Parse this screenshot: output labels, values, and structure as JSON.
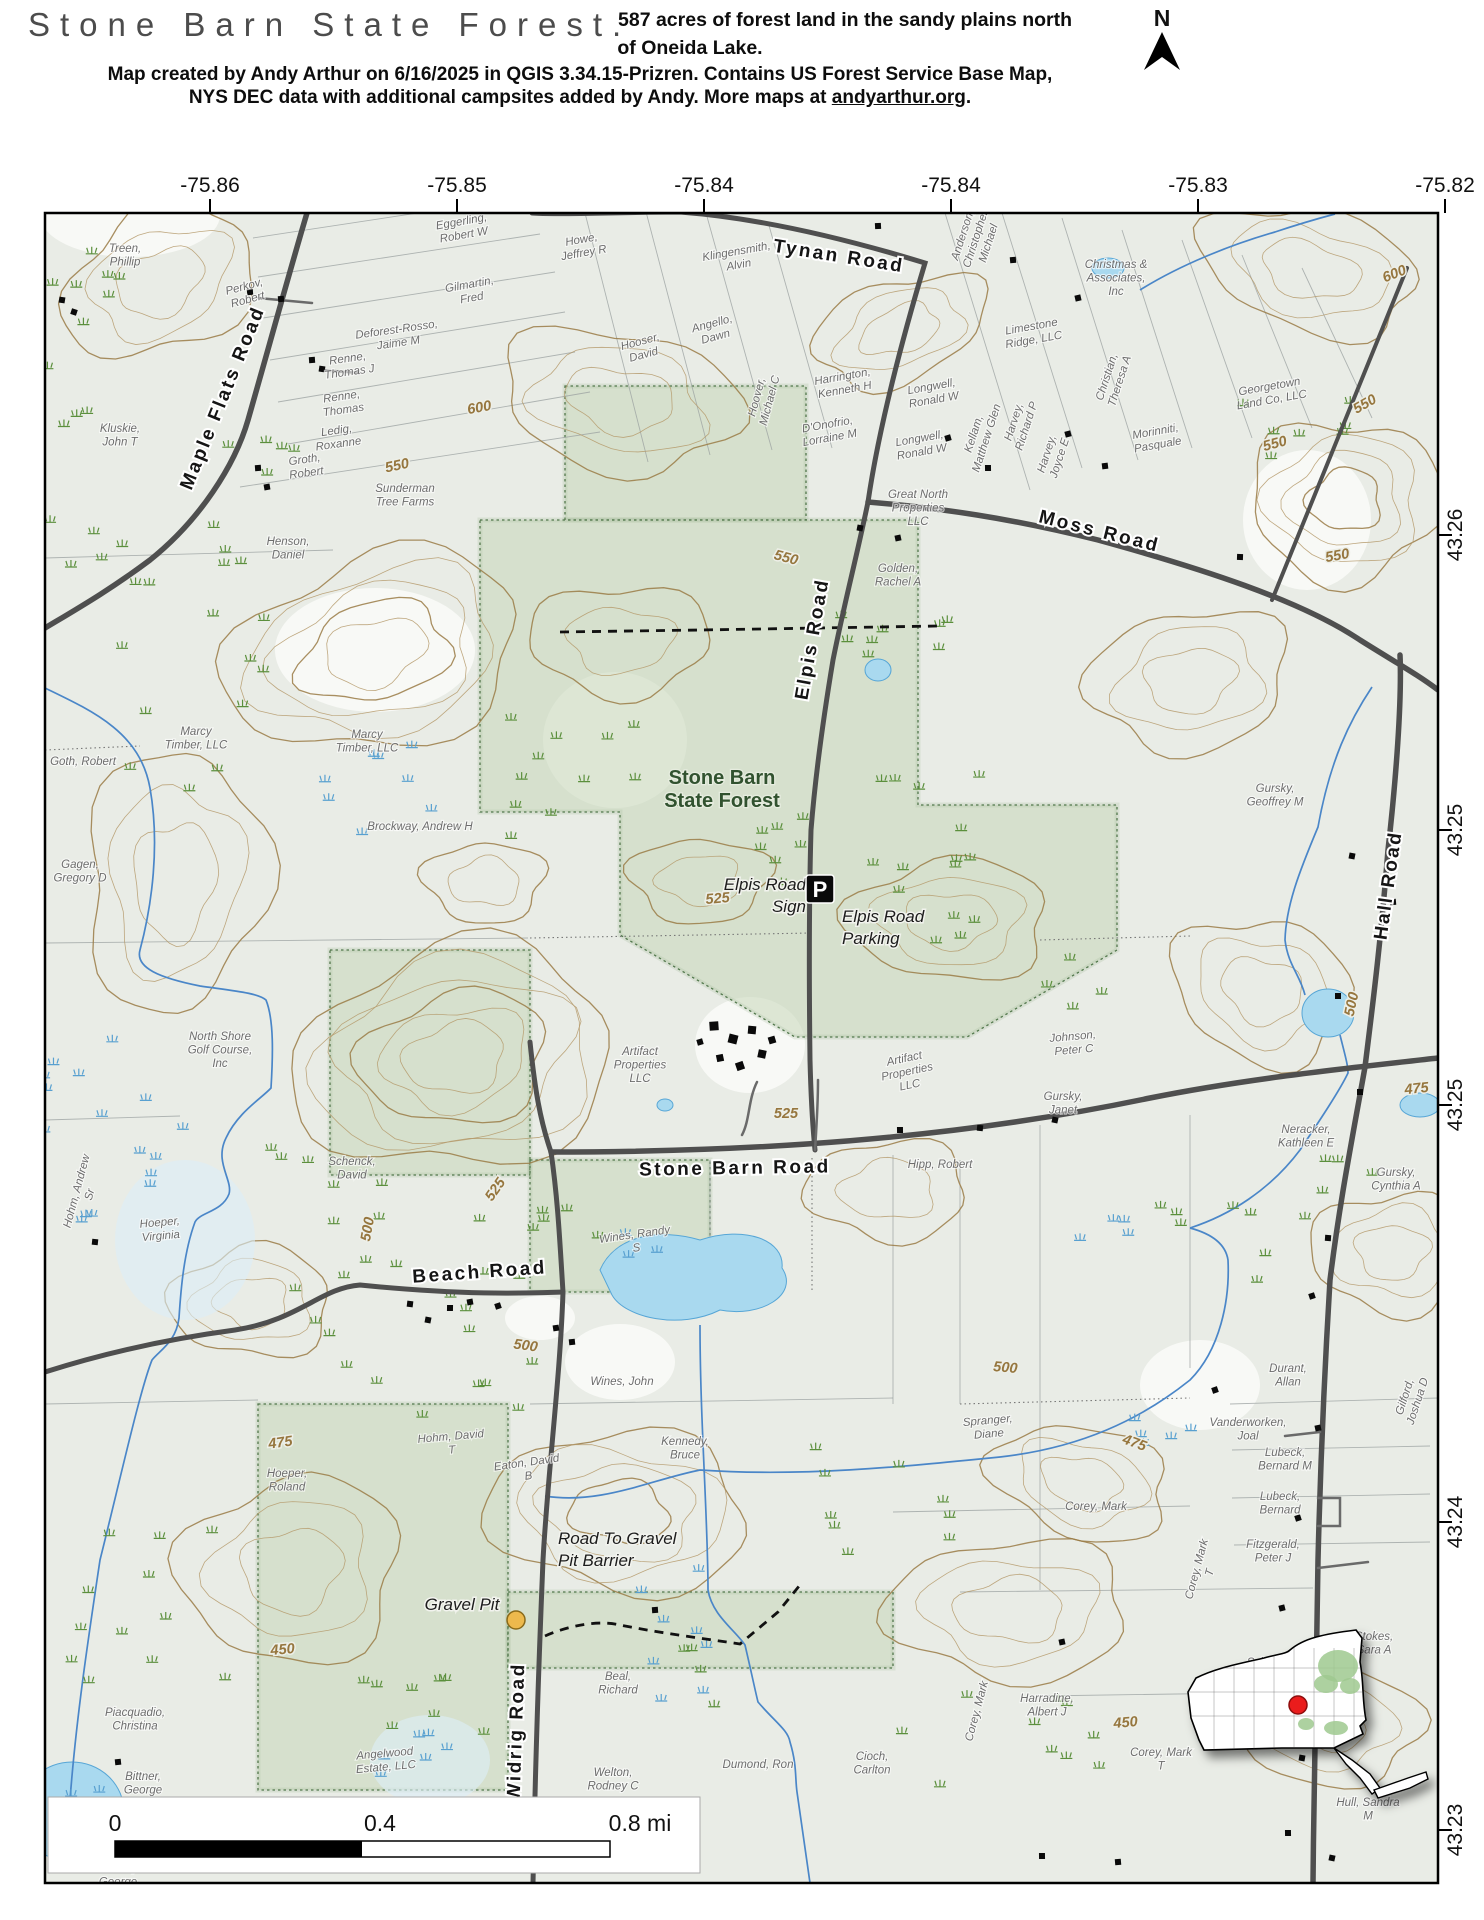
{
  "header": {
    "title": "Stone Barn State Forest.",
    "subtitle_line1": "587 acres of forest land in the sandy plains north",
    "subtitle_line2": "of Oneida Lake.",
    "credit_line1": "Map created by Andy Arthur on 6/16/2025 in QGIS 3.34.15-Prizren. Contains US Forest Service Base Map,",
    "credit_line2_prefix": "NYS DEC data with additional campsites added by Andy. More maps at ",
    "credit_link": "andyarthur.org",
    "credit_suffix": ".",
    "north_label": "N"
  },
  "axes": {
    "top": [
      {
        "label": "-75.86",
        "x": 210
      },
      {
        "label": "-75.85",
        "x": 457
      },
      {
        "label": "-75.84",
        "x": 704
      },
      {
        "label": "-75.84",
        "x": 951
      },
      {
        "label": "-75.83",
        "x": 1198
      },
      {
        "label": "-75.82",
        "x": 1445
      }
    ],
    "right": [
      {
        "label": "43.26",
        "y": 535
      },
      {
        "label": "43.25",
        "y": 830
      },
      {
        "label": "43.25",
        "y": 1105
      },
      {
        "label": "43.24",
        "y": 1522
      },
      {
        "label": "43.23",
        "y": 1830
      }
    ]
  },
  "scalebar": {
    "zero": "0",
    "mid": "0.4",
    "end": "0.8 mi"
  },
  "forest_label": {
    "lines": [
      "Stone Barn",
      "State Forest"
    ],
    "x": 722,
    "y": 784
  },
  "road_labels": [
    {
      "text": "Maple Flats Road",
      "x": 228,
      "y": 400,
      "r": -68
    },
    {
      "text": "Tynan Road",
      "x": 838,
      "y": 262,
      "r": 9
    },
    {
      "text": "Moss Road",
      "x": 1098,
      "y": 537,
      "r": 14
    },
    {
      "text": "Elpis Road",
      "x": 818,
      "y": 640,
      "r": -80
    },
    {
      "text": "Stone Barn Road",
      "x": 735,
      "y": 1174,
      "r": -1
    },
    {
      "text": "Beach Road",
      "x": 480,
      "y": 1278,
      "r": -4
    },
    {
      "text": "Hall Road",
      "x": 1394,
      "y": 886,
      "r": -82
    },
    {
      "text": "Widrig Road",
      "x": 522,
      "y": 1732,
      "r": -88
    }
  ],
  "contour_labels": [
    {
      "text": "600",
      "x": 1396,
      "y": 278,
      "r": -22
    },
    {
      "text": "600",
      "x": 480,
      "y": 412,
      "r": -10
    },
    {
      "text": "550",
      "x": 398,
      "y": 470,
      "r": -12
    },
    {
      "text": "550",
      "x": 785,
      "y": 562,
      "r": 15
    },
    {
      "text": "550",
      "x": 1367,
      "y": 408,
      "r": -30
    },
    {
      "text": "550",
      "x": 1276,
      "y": 448,
      "r": -15
    },
    {
      "text": "550",
      "x": 1338,
      "y": 560,
      "r": -10
    },
    {
      "text": "525",
      "x": 499,
      "y": 1192,
      "r": -55
    },
    {
      "text": "525",
      "x": 786,
      "y": 1118,
      "r": 0
    },
    {
      "text": "525",
      "x": 718,
      "y": 903,
      "r": -5
    },
    {
      "text": "500",
      "x": 372,
      "y": 1230,
      "r": -80
    },
    {
      "text": "500",
      "x": 525,
      "y": 1350,
      "r": 8
    },
    {
      "text": "500",
      "x": 1356,
      "y": 1005,
      "r": -78
    },
    {
      "text": "500",
      "x": 1005,
      "y": 1372,
      "r": 5
    },
    {
      "text": "475",
      "x": 281,
      "y": 1447,
      "r": -8
    },
    {
      "text": "475",
      "x": 1133,
      "y": 1447,
      "r": 20
    },
    {
      "text": "475",
      "x": 1417,
      "y": 1093,
      "r": -6
    },
    {
      "text": "450",
      "x": 283,
      "y": 1654,
      "r": -5
    },
    {
      "text": "450",
      "x": 1126,
      "y": 1727,
      "r": -5
    }
  ],
  "owner_labels": [
    {
      "l": [
        "Treen,",
        "Phillip"
      ],
      "x": 125,
      "y": 252,
      "r": 0
    },
    {
      "l": [
        "Perkov,",
        "Robert"
      ],
      "x": 245,
      "y": 290,
      "r": -15
    },
    {
      "l": [
        "Eggerling,",
        "Robert W"
      ],
      "x": 462,
      "y": 225,
      "r": -10
    },
    {
      "l": [
        "Howe,",
        "Jeffrey R"
      ],
      "x": 582,
      "y": 243,
      "r": -10
    },
    {
      "l": [
        "Gilmartin,",
        "Fred"
      ],
      "x": 470,
      "y": 288,
      "r": -10
    },
    {
      "l": [
        "Klingensmith,",
        "Alvin"
      ],
      "x": 737,
      "y": 255,
      "r": -10
    },
    {
      "l": [
        "Hooser,",
        "David"
      ],
      "x": 641,
      "y": 345,
      "r": -15
    },
    {
      "l": [
        "Angello,",
        "Dawn"
      ],
      "x": 713,
      "y": 327,
      "r": -15
    },
    {
      "l": [
        "Deforest-Rosso,",
        "Jaime M"
      ],
      "x": 397,
      "y": 333,
      "r": -8
    },
    {
      "l": [
        "Renne,",
        "Thomas J"
      ],
      "x": 348,
      "y": 362,
      "r": -8
    },
    {
      "l": [
        "Renne,",
        "Thomas"
      ],
      "x": 342,
      "y": 400,
      "r": -8
    },
    {
      "l": [
        "Ledig,",
        "Roxanne"
      ],
      "x": 337,
      "y": 434,
      "r": -8
    },
    {
      "l": [
        "Groth,",
        "Robert"
      ],
      "x": 305,
      "y": 463,
      "r": -8
    },
    {
      "l": [
        "Kluskie,",
        "John T"
      ],
      "x": 120,
      "y": 432,
      "r": 0
    },
    {
      "l": [
        "Hoover,",
        "Michael C"
      ],
      "x": 760,
      "y": 398,
      "r": -75
    },
    {
      "l": [
        "Harrington,",
        "Kenneth H"
      ],
      "x": 843,
      "y": 380,
      "r": -10
    },
    {
      "l": [
        "D'Onofrio,",
        "Lorraine  M"
      ],
      "x": 828,
      "y": 428,
      "r": -10
    },
    {
      "l": [
        "Longwell,",
        "Ronald W"
      ],
      "x": 932,
      "y": 390,
      "r": -10
    },
    {
      "l": [
        "Longwell,",
        "Ronald W"
      ],
      "x": 920,
      "y": 442,
      "r": -10
    },
    {
      "l": [
        "Kellam,",
        "Matthew Glen"
      ],
      "x": 977,
      "y": 435,
      "r": -72
    },
    {
      "l": [
        "Harvey,",
        "Richard P"
      ],
      "x": 1017,
      "y": 423,
      "r": -72
    },
    {
      "l": [
        "Harvey,",
        "Joyce E"
      ],
      "x": 1050,
      "y": 455,
      "r": -72
    },
    {
      "l": [
        "Anderson,",
        "Christopher",
        "Michael"
      ],
      "x": 966,
      "y": 236,
      "r": -72
    },
    {
      "l": [
        "Christmas &",
        "Associates,",
        "Inc"
      ],
      "x": 1116,
      "y": 268,
      "r": 0
    },
    {
      "l": [
        "Limestone",
        "Ridge, LLC"
      ],
      "x": 1032,
      "y": 330,
      "r": -10
    },
    {
      "l": [
        "Christian,",
        "Theresa A"
      ],
      "x": 1110,
      "y": 378,
      "r": -72
    },
    {
      "l": [
        "Georgetown",
        "Land Co, LLC"
      ],
      "x": 1270,
      "y": 390,
      "r": -10
    },
    {
      "l": [
        "Morinniti,",
        "Pasquale"
      ],
      "x": 1156,
      "y": 435,
      "r": -10
    },
    {
      "l": [
        "Great North",
        "Properties",
        "LLC"
      ],
      "x": 918,
      "y": 498,
      "r": 0
    },
    {
      "l": [
        "Golden,",
        "Rachel A"
      ],
      "x": 898,
      "y": 572,
      "r": 0
    },
    {
      "l": [
        "Sunderman",
        "Tree Farms"
      ],
      "x": 405,
      "y": 492,
      "r": 0
    },
    {
      "l": [
        "Henson,",
        "Daniel"
      ],
      "x": 288,
      "y": 545,
      "r": 0
    },
    {
      "l": [
        "Marcy",
        "Timber, LLC"
      ],
      "x": 196,
      "y": 735,
      "r": 0
    },
    {
      "l": [
        "Marcy",
        "Timber, LLC"
      ],
      "x": 367,
      "y": 738,
      "r": 0
    },
    {
      "l": [
        "Goth, Robert"
      ],
      "x": 83,
      "y": 765,
      "r": 0
    },
    {
      "l": [
        "Gagen,",
        "Gregory D"
      ],
      "x": 80,
      "y": 868,
      "r": 0
    },
    {
      "l": [
        "North Shore",
        "Golf Course,",
        "Inc"
      ],
      "x": 220,
      "y": 1040,
      "r": 0
    },
    {
      "l": [
        "Brockway, Andrew H"
      ],
      "x": 420,
      "y": 830,
      "r": 0
    },
    {
      "l": [
        "Hohm, Andrew",
        "Sr"
      ],
      "x": 80,
      "y": 1192,
      "r": -75
    },
    {
      "l": [
        "Hoeper,",
        "Virginia"
      ],
      "x": 160,
      "y": 1226,
      "r": -5
    },
    {
      "l": [
        "Schenck,",
        "David"
      ],
      "x": 352,
      "y": 1165,
      "r": 0
    },
    {
      "l": [
        "Artifact",
        "Properties",
        "LLC"
      ],
      "x": 640,
      "y": 1055,
      "r": 0
    },
    {
      "l": [
        "Artifact",
        "Properties",
        "LLC"
      ],
      "x": 905,
      "y": 1062,
      "r": -12
    },
    {
      "l": [
        "Johnson,",
        "Peter C"
      ],
      "x": 1073,
      "y": 1040,
      "r": -5
    },
    {
      "l": [
        "Gursky,",
        "Janet"
      ],
      "x": 1063,
      "y": 1100,
      "r": 0
    },
    {
      "l": [
        "Gursky,",
        "Geoffrey M"
      ],
      "x": 1275,
      "y": 792,
      "r": 0
    },
    {
      "l": [
        "Hipp, Robert"
      ],
      "x": 940,
      "y": 1168,
      "r": 0
    },
    {
      "l": [
        "Neracker,",
        "Kathleen E"
      ],
      "x": 1306,
      "y": 1133,
      "r": 0
    },
    {
      "l": [
        "Gursky,",
        "Cynthia A"
      ],
      "x": 1396,
      "y": 1176,
      "r": 0
    },
    {
      "l": [
        "Wines, Randy",
        "S"
      ],
      "x": 635,
      "y": 1238,
      "r": -8
    },
    {
      "l": [
        "Wines, John"
      ],
      "x": 622,
      "y": 1385,
      "r": 0
    },
    {
      "l": [
        "Kennedy,",
        "Bruce"
      ],
      "x": 685,
      "y": 1445,
      "r": 0
    },
    {
      "l": [
        "Hohm, David",
        "T"
      ],
      "x": 451,
      "y": 1440,
      "r": -5
    },
    {
      "l": [
        "Eaton, David",
        "B"
      ],
      "x": 527,
      "y": 1466,
      "r": -8
    },
    {
      "l": [
        "Hoeper,",
        "Roland"
      ],
      "x": 287,
      "y": 1477,
      "r": 0
    },
    {
      "l": [
        "Spranger,",
        "Diane"
      ],
      "x": 988,
      "y": 1424,
      "r": -5
    },
    {
      "l": [
        "Corey, Mark"
      ],
      "x": 1096,
      "y": 1510,
      "r": 0
    },
    {
      "l": [
        "Corey, Mark",
        "T"
      ],
      "x": 1200,
      "y": 1570,
      "r": -75
    },
    {
      "l": [
        "Corey, Mark"
      ],
      "x": 980,
      "y": 1712,
      "r": -75
    },
    {
      "l": [
        "Corey, Mark",
        "T"
      ],
      "x": 1161,
      "y": 1756,
      "r": 0
    },
    {
      "l": [
        "Durant,",
        "Allan"
      ],
      "x": 1288,
      "y": 1372,
      "r": 0
    },
    {
      "l": [
        "Gilford,",
        "Joshua D"
      ],
      "x": 1408,
      "y": 1398,
      "r": -72
    },
    {
      "l": [
        "Vanderworken,",
        "Joal"
      ],
      "x": 1248,
      "y": 1426,
      "r": 0
    },
    {
      "l": [
        "Lubeck,",
        "Bernard M"
      ],
      "x": 1285,
      "y": 1456,
      "r": 0
    },
    {
      "l": [
        "Lubeck,",
        "Bernard"
      ],
      "x": 1280,
      "y": 1500,
      "r": 0
    },
    {
      "l": [
        "Fitzgerald,",
        "Peter J"
      ],
      "x": 1273,
      "y": 1548,
      "r": 0
    },
    {
      "l": [
        "Schwartz,",
        "Barbara"
      ],
      "x": 1272,
      "y": 1666,
      "r": 0
    },
    {
      "l": [
        "Harradine,",
        "Albert J"
      ],
      "x": 1047,
      "y": 1702,
      "r": 0
    },
    {
      "l": [
        "Stokes,",
        "Sara A"
      ],
      "x": 1374,
      "y": 1640,
      "r": 0
    },
    {
      "l": [
        "Hull, Sandra",
        "M"
      ],
      "x": 1368,
      "y": 1806,
      "r": 0
    },
    {
      "l": [
        "Dumond, Ron"
      ],
      "x": 758,
      "y": 1768,
      "r": 0
    },
    {
      "l": [
        "Cioch,",
        "Carlton"
      ],
      "x": 872,
      "y": 1760,
      "r": 0
    },
    {
      "l": [
        "Welton,",
        "Rodney C"
      ],
      "x": 613,
      "y": 1776,
      "r": 0
    },
    {
      "l": [
        "Beal,",
        "Richard"
      ],
      "x": 618,
      "y": 1680,
      "r": 0
    },
    {
      "l": [
        "Bittner,",
        "George"
      ],
      "x": 143,
      "y": 1780,
      "r": 0
    },
    {
      "l": [
        "Bittner,",
        "George"
      ],
      "x": 118,
      "y": 1872,
      "r": 0
    },
    {
      "l": [
        "Piacquadio,",
        "Christina"
      ],
      "x": 135,
      "y": 1716,
      "r": 0
    },
    {
      "l": [
        "Angelwood",
        "Estate, LLC"
      ],
      "x": 385,
      "y": 1757,
      "r": -5
    }
  ],
  "poi": {
    "sign_label": {
      "lines": [
        "Elpis Road",
        "Sign"
      ],
      "x": 806,
      "y": 890,
      "anchor": "end"
    },
    "parking_label": {
      "lines": [
        "Elpis Road",
        "Parking"
      ],
      "x": 842,
      "y": 922,
      "anchor": "start"
    },
    "parking_icon": {
      "glyph": "P",
      "x": 806,
      "y": 875
    },
    "gravel_pit_label": {
      "text": "Gravel Pit",
      "x": 462,
      "y": 1610
    },
    "gravel_pit_dot": {
      "x": 516,
      "y": 1620
    },
    "barrier_label": {
      "lines": [
        "Road To Gravel",
        "Pit Barrier"
      ],
      "x": 558,
      "y": 1544,
      "anchor": "start"
    }
  },
  "colors": {
    "map_bg": "#e9ece6",
    "forest_fill": "#c7d8ba",
    "forest_edge": "#51774b",
    "road": "#4f4f4f",
    "water_fill": "#a9d9ef",
    "water_edge": "#57a6d6",
    "stream": "#4a86c8",
    "contour": "#b59a6b",
    "index_contour": "#9a7b45",
    "marsh_green": "#5b8f3c",
    "marsh_blue": "#58a0d0",
    "inset_dot": "#ea1a1a",
    "parking_bg": "#0a0a0a"
  }
}
